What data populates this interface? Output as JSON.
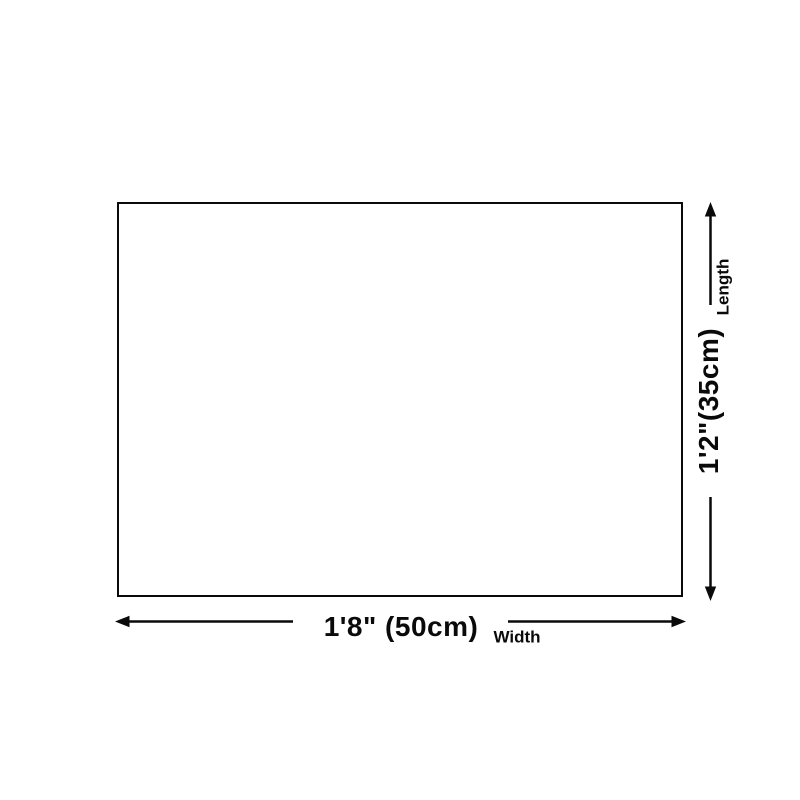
{
  "diagram": {
    "type": "product-dimension-diagram",
    "dimensions": {
      "length": {
        "axis_label": "Length",
        "value": "1'2\"(35cm)",
        "arrow_orientation": "vertical"
      },
      "width": {
        "axis_label": "Width",
        "value": "1'8\" (50cm)",
        "arrow_orientation": "horizontal"
      }
    },
    "icons": [
      "arrow-up-icon",
      "arrow-down-icon",
      "arrow-left-icon",
      "arrow-right-icon"
    ],
    "colors": {
      "background": "#ffffff",
      "line": "#0a0a0a",
      "text": "#0a0a0a",
      "rectangle_fill": "#ffffff"
    }
  }
}
